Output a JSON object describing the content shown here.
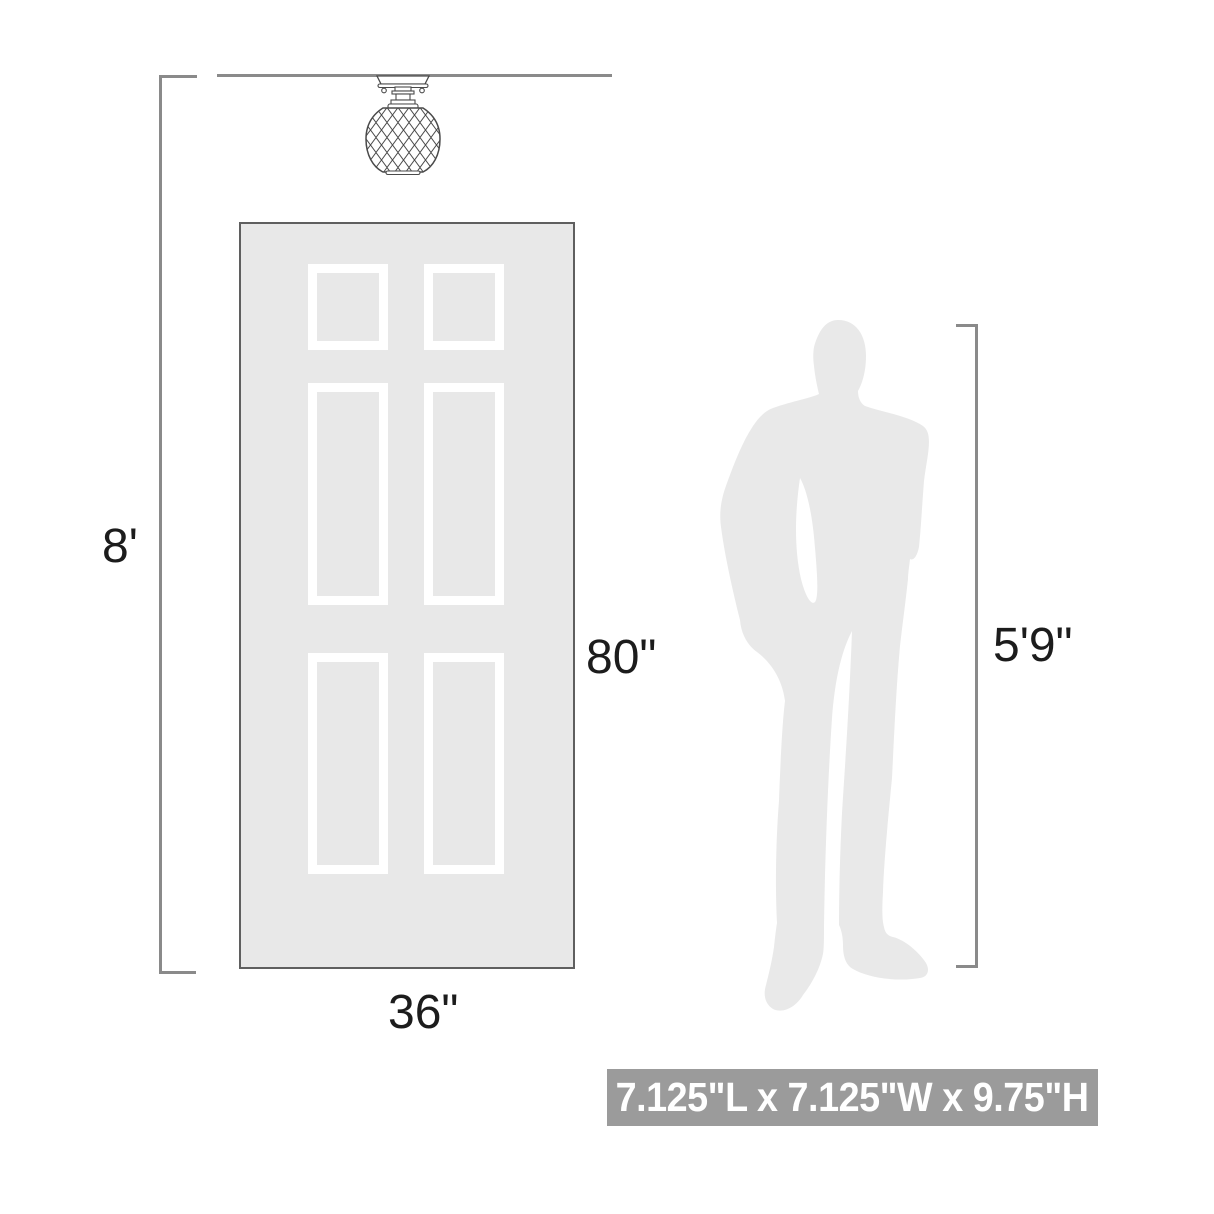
{
  "scene": {
    "type": "product-scale-diagram",
    "ceiling_height_label": "8'",
    "door_height_label": "80\"",
    "door_width_label": "36\"",
    "person_height_label": "5'9\"",
    "banner_text": "7.125\"L x 7.125\"W x 9.75\"H"
  },
  "icons": {
    "fixture": "flush-mount-crystal-light",
    "door": "six-panel-door",
    "person": "standing-man-silhouette"
  },
  "colors": {
    "line_gray": "#8a8a8a",
    "door_fill": "#e8e8e8",
    "door_border": "#5f5f5f",
    "panel_frame": "#ffffff",
    "silhouette_gray": "#e9e9e9",
    "fixture_stroke": "#4a4a4a",
    "banner_background": "#9b9b9b",
    "banner_text_color": "#ffffff",
    "label_color": "#1c1c1c"
  }
}
